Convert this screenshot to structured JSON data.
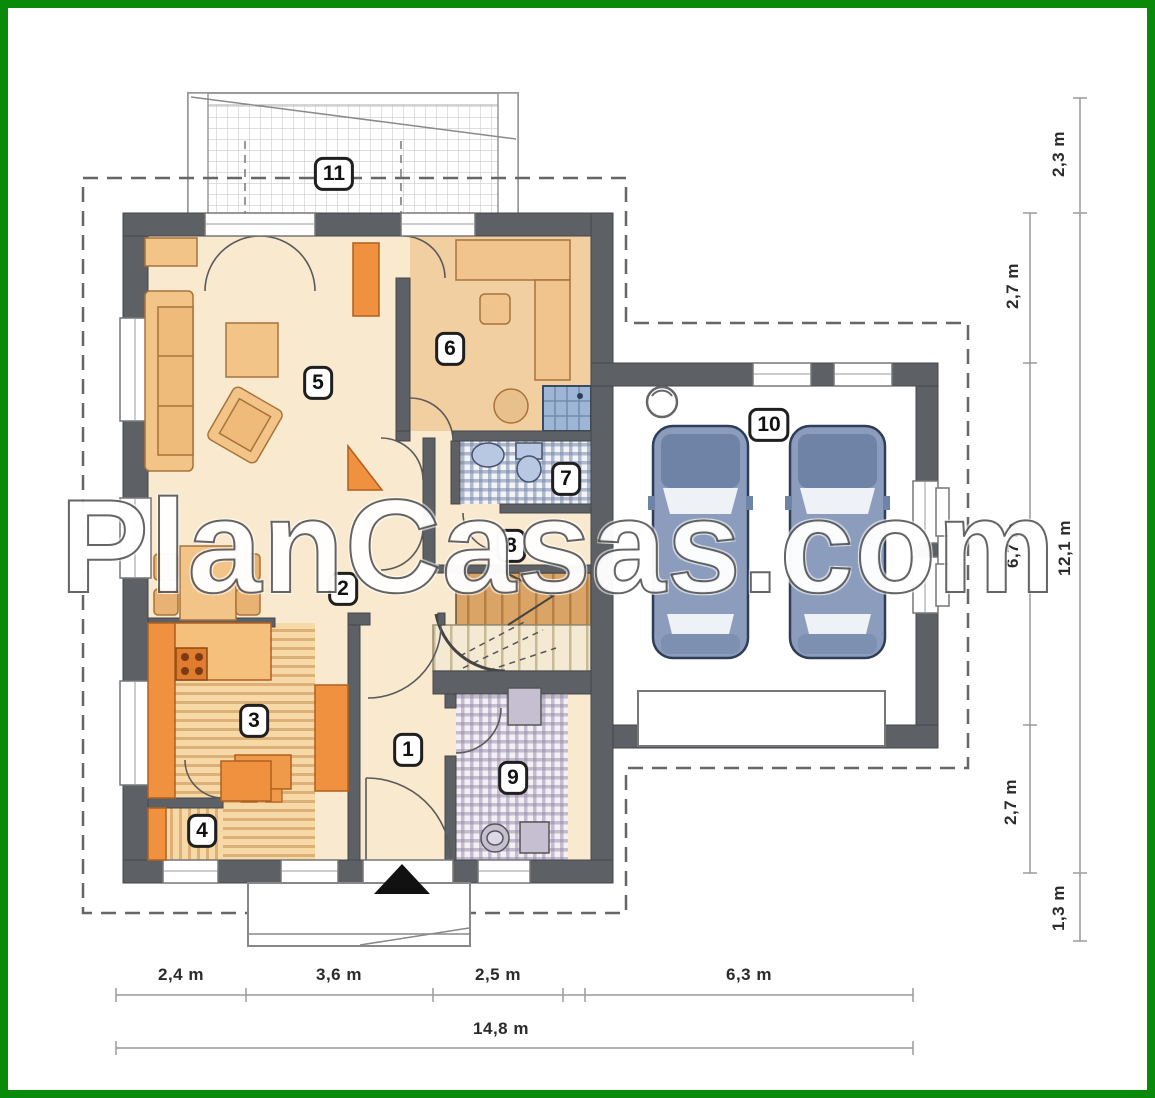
{
  "watermark": "PlanCasas.com",
  "rooms": [
    "1",
    "2",
    "3",
    "4",
    "5",
    "6",
    "7",
    "8",
    "9",
    "10",
    "11"
  ],
  "dimensions": {
    "bottom_row": [
      "2,4 m",
      "3,6 m",
      "2,5 m",
      "6,3 m"
    ],
    "bottom_total": "14,8 m",
    "right_inner": [
      "2,7 m",
      "6,7 m",
      "2,7 m"
    ],
    "right_outer": [
      "2,3 m",
      "12,1 m",
      "1,3 m"
    ]
  },
  "colors": {
    "frame_green": "#0a8a0a",
    "wall_gray": "#5d6166",
    "floor_cream": "#f8e9cf",
    "floor_tan": "#f2cfa0",
    "furniture_orange": "#f0913f",
    "furniture_light": "#f3c488",
    "car_blue": "#8b9cbc",
    "shower_blue": "#9db6d6",
    "dimension_text": "#2b2b2b"
  }
}
